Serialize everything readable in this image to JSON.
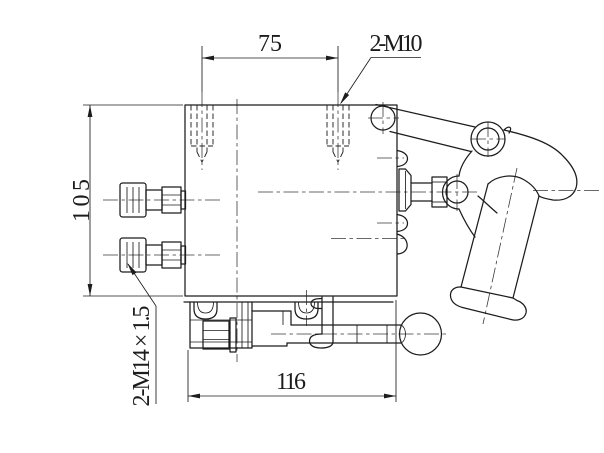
{
  "style": {
    "background": "#ffffff",
    "line_color": "#1c1c1c"
  },
  "annotations": {
    "dim_top_width": "75",
    "label_top_threads": "2-M10",
    "dim_left_height": "105",
    "label_left_threads": "2-M14 × 1.5",
    "dim_bottom_width": "116"
  }
}
